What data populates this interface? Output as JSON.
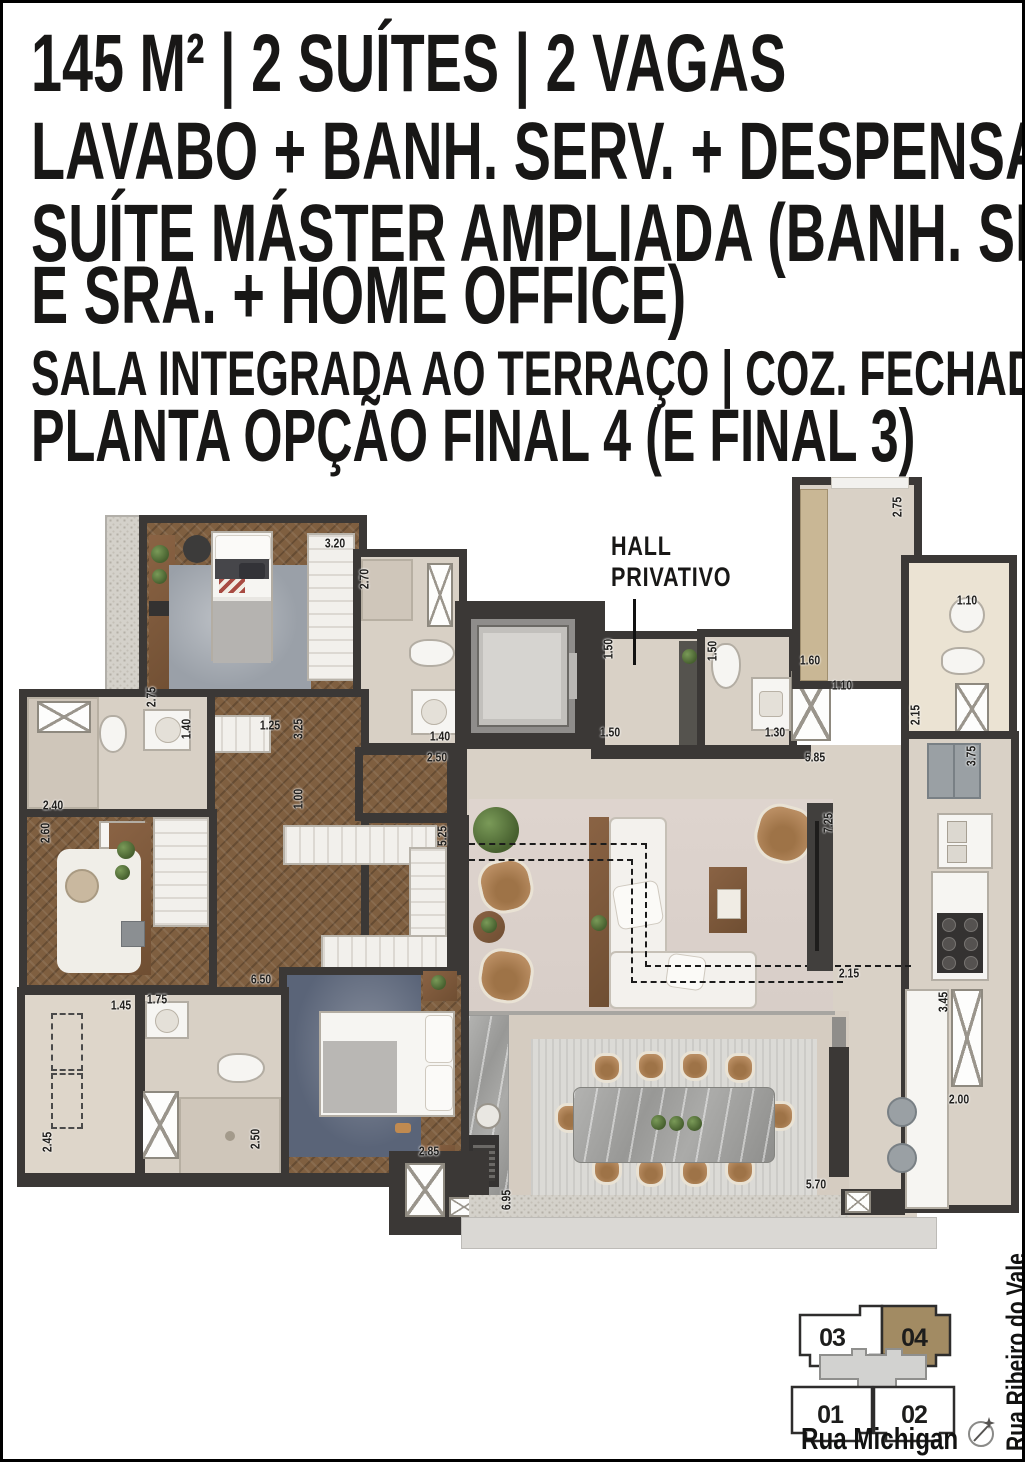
{
  "header": {
    "line1": "145 M² | 2 SUÍTES | 2 VAGAS",
    "line2": "LAVABO + BANH. SERV. + DESPENSA",
    "line3a": "SUÍTE MÁSTER AMPLIADA (BANH. SR.",
    "line3b": "E SRA. + HOME OFFICE)",
    "line4": "SALA INTEGRADA AO TERRAÇO | COZ. FECHADA",
    "line5": "PLANTA OPÇÃO FINAL 4 (E FINAL 3)"
  },
  "plan": {
    "hall_label_line1": "HALL",
    "hall_label_line2": "PRIVATIVO",
    "dimensions": [
      {
        "value": "3.20",
        "x": 332,
        "y": 540,
        "rot": 0
      },
      {
        "value": "2.70",
        "x": 361,
        "y": 576,
        "rot": -90
      },
      {
        "value": "2.75",
        "x": 148,
        "y": 694,
        "rot": -90
      },
      {
        "value": "1.40",
        "x": 183,
        "y": 726,
        "rot": -90
      },
      {
        "value": "1.25",
        "x": 267,
        "y": 722,
        "rot": 0
      },
      {
        "value": "3.25",
        "x": 295,
        "y": 726,
        "rot": -90
      },
      {
        "value": "1.40",
        "x": 437,
        "y": 733,
        "rot": 0
      },
      {
        "value": "2.50",
        "x": 434,
        "y": 754,
        "rot": 0
      },
      {
        "value": "2.40",
        "x": 50,
        "y": 802,
        "rot": 0
      },
      {
        "value": "2.60",
        "x": 42,
        "y": 830,
        "rot": -90
      },
      {
        "value": "1.00",
        "x": 295,
        "y": 796,
        "rot": -90
      },
      {
        "value": "5.25",
        "x": 439,
        "y": 833,
        "rot": -90
      },
      {
        "value": "6.50",
        "x": 258,
        "y": 976,
        "rot": 0
      },
      {
        "value": "1.45",
        "x": 118,
        "y": 1002,
        "rot": 0
      },
      {
        "value": "1.75",
        "x": 154,
        "y": 996,
        "rot": 0
      },
      {
        "value": "2.45",
        "x": 44,
        "y": 1139,
        "rot": -90
      },
      {
        "value": "2.50",
        "x": 252,
        "y": 1136,
        "rot": -90
      },
      {
        "value": "2.85",
        "x": 426,
        "y": 1148,
        "rot": 0
      },
      {
        "value": "6.95",
        "x": 503,
        "y": 1197,
        "rot": -90
      },
      {
        "value": "5.70",
        "x": 813,
        "y": 1181,
        "rot": 0
      },
      {
        "value": "2.00",
        "x": 956,
        "y": 1096,
        "rot": 0
      },
      {
        "value": "3.45",
        "x": 940,
        "y": 999,
        "rot": -90
      },
      {
        "value": "2.15",
        "x": 846,
        "y": 970,
        "rot": 0
      },
      {
        "value": "7.25",
        "x": 825,
        "y": 820,
        "rot": -90
      },
      {
        "value": "5.85",
        "x": 812,
        "y": 754,
        "rot": 0
      },
      {
        "value": "3.75",
        "x": 968,
        "y": 753,
        "rot": -90
      },
      {
        "value": "2.15",
        "x": 912,
        "y": 712,
        "rot": -90
      },
      {
        "value": "1.10",
        "x": 964,
        "y": 597,
        "rot": 0
      },
      {
        "value": "1.10",
        "x": 839,
        "y": 682,
        "rot": 0
      },
      {
        "value": "1.60",
        "x": 807,
        "y": 657,
        "rot": 0
      },
      {
        "value": "2.75",
        "x": 894,
        "y": 504,
        "rot": -90
      },
      {
        "value": "1.50",
        "x": 605,
        "y": 646,
        "rot": -90
      },
      {
        "value": "1.50",
        "x": 607,
        "y": 729,
        "rot": 0
      },
      {
        "value": "1.50",
        "x": 709,
        "y": 648,
        "rot": -90
      },
      {
        "value": "1.30",
        "x": 772,
        "y": 729,
        "rot": 0
      }
    ]
  },
  "keyplan": {
    "units": [
      {
        "label": "03",
        "highlighted": false
      },
      {
        "label": "04",
        "highlighted": true
      },
      {
        "label": "01",
        "highlighted": false
      },
      {
        "label": "02",
        "highlighted": false
      }
    ],
    "street_bottom": "Rua Michigan",
    "street_right": "Rua Ribeiro do Vale"
  },
  "colors": {
    "wall": "#3b3836",
    "wood": "#7f5f40",
    "beige": "#d9d1c6",
    "kp-hl": "#a28b63",
    "tan": "#b08455"
  }
}
